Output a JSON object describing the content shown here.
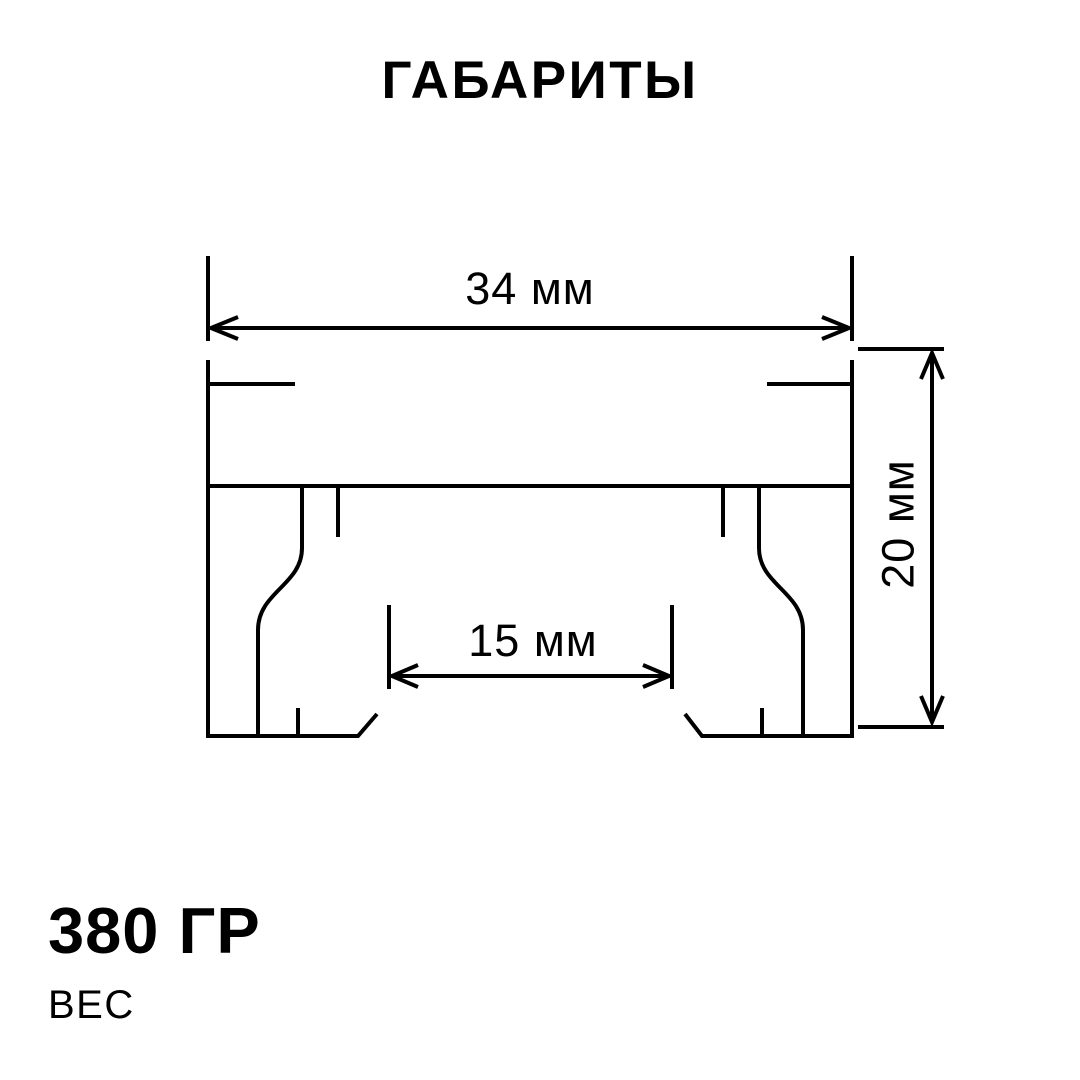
{
  "title": "ГАБАРИТЫ",
  "drawing": {
    "description": "profile-cross-section-dimension-drawing",
    "width_dim": {
      "label": "34 мм"
    },
    "height_dim": {
      "label": "20 мм"
    },
    "inner_dim": {
      "label": "15 мм"
    }
  },
  "weight": {
    "value": "380 ГР",
    "caption": "ВЕС"
  },
  "colors": {
    "ink": "#000000",
    "background": "#ffffff"
  }
}
